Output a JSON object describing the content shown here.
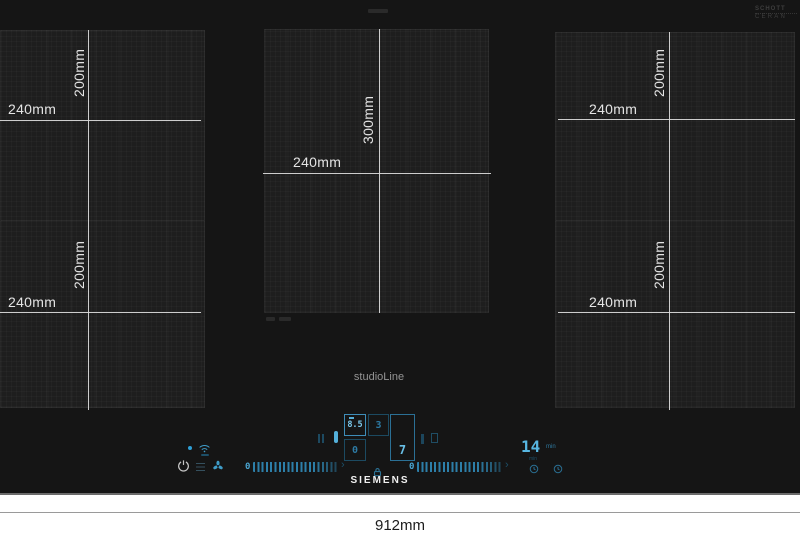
{
  "product": {
    "brand": "SIEMENS",
    "line": "studioLine",
    "glass_brand_line1": "SCHOTT",
    "glass_brand_line2": "CERAN"
  },
  "dimension_labels": {
    "overall_width": "912mm",
    "left_top_width": "240mm",
    "left_top_height": "200mm",
    "left_bottom_width": "240mm",
    "left_bottom_height": "200mm",
    "center_width": "240mm",
    "center_height": "300mm",
    "right_top_width": "240mm",
    "right_top_height": "200mm",
    "right_bottom_width": "240mm",
    "right_bottom_height": "200mm"
  },
  "control_panel": {
    "zone_display_1": "8.5",
    "zone_display_2": "3",
    "zone_display_3": "0",
    "zone_display_4": "7",
    "slider_left_min": "0",
    "slider_right_min": "0",
    "slider_arrow": "›",
    "timer_value": "14",
    "timer_unit": "min",
    "timer_sub_unit": "min"
  },
  "icons": {
    "power_icon": "standby circle with line",
    "wifi_icon": "home-connect wifi arcs",
    "hood_fan_icon": "three-blade ventilation fan",
    "menu_icon": "stacked lines",
    "pause_icon": "double vertical bars",
    "lock_icon": "padlock child lock",
    "clock_icon": "timer clock face",
    "status_dot": "blue indicator dot"
  },
  "colors": {
    "body": "#151515",
    "zone": "#1e1e1e",
    "dimension_line": "#dcdcdc",
    "accent_cyan": "#3f9cc8",
    "accent_cyan_bright": "#6cc2e8",
    "accent_cyan_dim": "#1d4f68",
    "logo_white": "#f0f0f0",
    "studio_line_gray": "#949494"
  }
}
